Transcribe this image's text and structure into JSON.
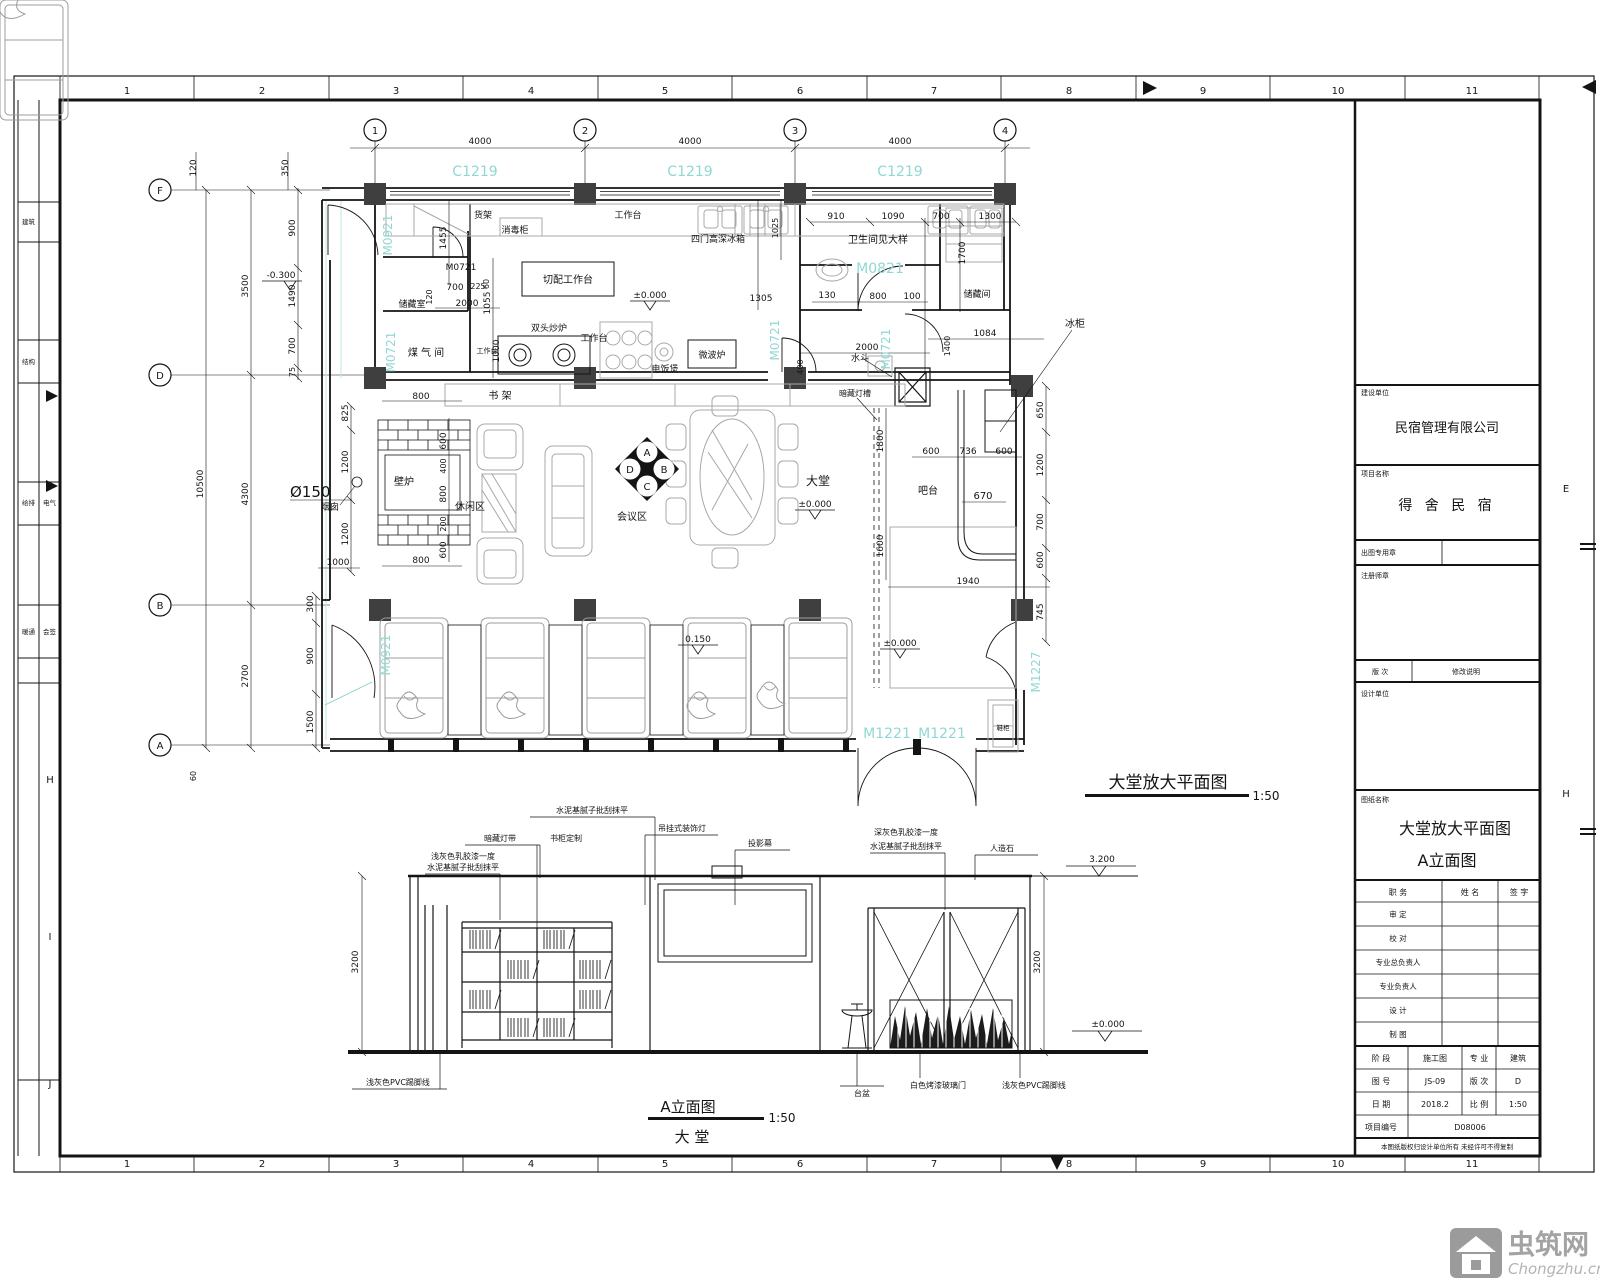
{
  "sheet": {
    "ruler_numbers": [
      "1",
      "2",
      "3",
      "4",
      "5",
      "6",
      "7",
      "8",
      "9",
      "10",
      "11"
    ],
    "left_letters": [
      "H",
      "I",
      "J"
    ],
    "right_letters": [
      "E",
      "H"
    ],
    "strip_labels": [
      "建筑",
      "结构",
      "给排",
      "电气",
      "暖通",
      "会签"
    ]
  },
  "plan": {
    "title": "大堂放大平面图",
    "scale": "1:50",
    "grid_cols": [
      "1",
      "2",
      "3",
      "4"
    ],
    "grid_rows": [
      "F",
      "D",
      "B",
      "A"
    ],
    "window_tags": [
      "C1219",
      "C1219",
      "C1219"
    ],
    "door_tags": {
      "m0921_top": "M0921",
      "m0921_bottom": "M0921",
      "m0721_black": "M0721",
      "m0721_left": "M0721",
      "m0721_mid": "M0721",
      "m0721_right": "M0721",
      "m0821": "M0821",
      "m1221_l": "M1221",
      "m1221_r": "M1221",
      "m1227": "M1227"
    },
    "labels": {
      "shelf": "货架",
      "sterilizer": "消毒柜",
      "worktop1": "工作台",
      "fridge4": "四门高深冰箱",
      "prep": "切配工作台",
      "storage1": "储藏室",
      "gasroom": "煤 气 间",
      "wok": "双头炒炉",
      "worktop2": "工作台",
      "worktop3": "工作台",
      "ricecooker": "电饭煲",
      "microwave": "微波炉",
      "bookshelf": "书 架",
      "fireplace": "壁炉",
      "chimney": "烟囱",
      "leisure": "休闲区",
      "meeting": "会议区",
      "lobby": "大堂",
      "bar": "吧台",
      "freezer": "冰柜",
      "toilet": "卫生间见大样",
      "storage2": "储藏间",
      "sink": "水斗",
      "lightcove": "暗藏灯槽",
      "cabinet": "鞋柜"
    },
    "marks": {
      "dia": "Ø150",
      "pm0_a": "±0.000",
      "pm0_b": "±0.000",
      "pm0_c": "±0.000",
      "p150": "0.150",
      "m300": "-0.300"
    },
    "diamond": [
      "A",
      "B",
      "C",
      "D"
    ],
    "dims": [
      "4000",
      "4000",
      "4000",
      "120",
      "350",
      "910",
      "1090",
      "700",
      "1300",
      "1700",
      "130",
      "800",
      "100",
      "1084",
      "2000",
      "1455",
      "700",
      "2000",
      "120",
      "1055",
      "1000",
      "1305",
      "1800",
      "1600",
      "600",
      "736",
      "600",
      "670",
      "1940",
      "650",
      "1200",
      "700",
      "600",
      "745",
      "900",
      "1490",
      "700",
      "75",
      "3500",
      "4300",
      "2700",
      "10500",
      "825",
      "1200",
      "1200",
      "1000",
      "300",
      "900",
      "1500",
      "60",
      "800",
      "600",
      "400",
      "800",
      "200",
      "600",
      "800",
      "1400",
      "400",
      "1025",
      "60",
      "225"
    ]
  },
  "elevation": {
    "title": "A立面图",
    "scale": "1:50",
    "subtitle": "大  堂",
    "notes": [
      "浅灰色乳胶漆一度",
      "水泥基腻子批刮抹平",
      "暗藏灯带",
      "书柜定制",
      "水泥基腻子批刮抹平",
      "吊挂式装饰灯",
      "投影幕",
      "深灰色乳胶漆一度",
      "水泥基腻子批刮抹平",
      "人造石",
      "浅灰色PVC踢脚线",
      "白色烤漆玻璃门",
      "浅灰色PVC踢脚线",
      "台盆"
    ],
    "marks": {
      "top": "3.200",
      "bottom": "±0.000"
    },
    "dims": [
      "3200",
      "3200"
    ]
  },
  "titleblock": {
    "client_label": "建设单位",
    "client": "民宿管理有限公司",
    "project_label": "项目名称",
    "project": "得 舍 民 宿",
    "seal_label": "出图专用章",
    "reg_label": "注册师章",
    "rev_label": "版 次",
    "rev_desc": "修改说明",
    "design_label": "设计单位",
    "drawing_label": "图纸名称",
    "drawing1": "大堂放大平面图",
    "drawing2": "A立面图",
    "sig_headers": [
      "职 务",
      "姓 名",
      "签 字"
    ],
    "sig_rows": [
      "审 定",
      "校 对",
      "专业总负责人",
      "专业负责人",
      "设 计",
      "制 图"
    ],
    "stage_label": "阶 段",
    "stage": "施工图",
    "disc_label": "专 业",
    "disc": "建筑",
    "no_label": "图 号",
    "no": "JS-09",
    "ver_label": "版 次",
    "ver": "D",
    "date_label": "日 期",
    "date": "2018.2",
    "scale_label": "比 例",
    "scale": "1:50",
    "pid_label": "项目编号",
    "pid": "D08006",
    "note": "本图纸版权归设计单位所有 未经许可不得复制"
  },
  "watermark": {
    "cn": "虫筑网",
    "en": "Chongzhu.cn"
  }
}
